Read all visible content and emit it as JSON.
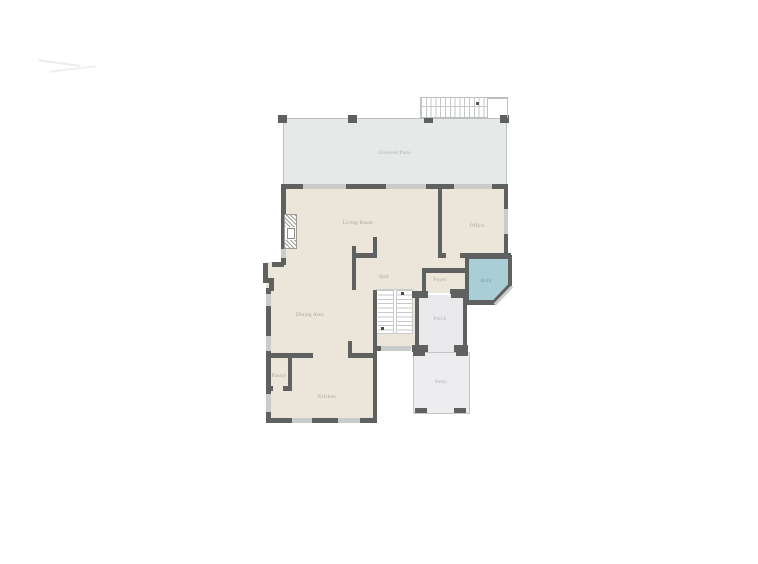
{
  "figure": {
    "kind": "floor-plan",
    "background": "#ffffff"
  },
  "palette": {
    "wall_dark": "#5f6060",
    "window_light": "#c9cccb",
    "floor_cream": "#ece5d9",
    "covered_patio_gray": "#e7e9e9",
    "porch_gray": "#e9e9eb",
    "patio_gray": "#ededef",
    "bath_teal": "#a9ced6",
    "outline_thin": "#bcc0c0",
    "label_text": "#a3a29b"
  },
  "rooms": {
    "covered_patio": {
      "label": "Covered Patio"
    },
    "living_room": {
      "label": "Living Room"
    },
    "office": {
      "label": "Office"
    },
    "hall": {
      "label": "Hall"
    },
    "foyer": {
      "label": "Foyer"
    },
    "bath": {
      "label": "Bath"
    },
    "dining_area": {
      "label": "Dining Area"
    },
    "porch": {
      "label": "Porch"
    },
    "patio": {
      "label": "Patio"
    },
    "pantry": {
      "label": "Pantry"
    },
    "kitchen": {
      "label": "Kitchen"
    }
  }
}
